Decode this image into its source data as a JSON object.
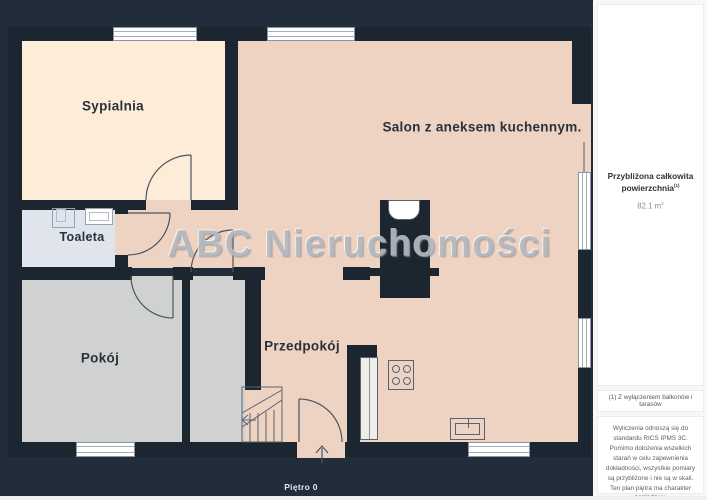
{
  "plan": {
    "watermark": "ABC Nieruchomości",
    "floor_label": "Piętro 0",
    "rooms": [
      {
        "id": "sypialnia",
        "label": "Sypialnia"
      },
      {
        "id": "salon",
        "label": "Salon z aneksem kuchennym."
      },
      {
        "id": "toaleta",
        "label": "Toaleta"
      },
      {
        "id": "pokoj",
        "label": "Pokój"
      },
      {
        "id": "przedpokoj",
        "label": "Przedpokój"
      }
    ]
  },
  "sidebar": {
    "area_card": {
      "title": "Przybliżona całkowita powierzchnia",
      "title_superscript": "(1)",
      "value": "82.1",
      "unit_base": "m",
      "unit_sup": "2"
    },
    "footnote": "(1) Z wyłączeniem balkonów i tarasów",
    "disclaimer": "Wyliczenia odnoszą się do standardu RICS IPMS 3C. Pomimo dołożenia wszelkich starań w celu zapewnienia dokładności, wszystkie pomiary są przybliżone i nie są w skali. Ten plan piętra ma charakter poglądowy.",
    "brand": {
      "regular": "GIRAFFE",
      "bold": "360"
    }
  },
  "colors": {
    "background": "#212d3b",
    "wall": "#1c2631",
    "bedroom_floor": "#fdecd8",
    "living_floor": "#eed3c3",
    "gray_room_floor": "#d0d2d1",
    "toilet_floor": "#e0e4ec",
    "outline_line": "#4a5461",
    "sidebar_bg": "#f6f7f8"
  }
}
